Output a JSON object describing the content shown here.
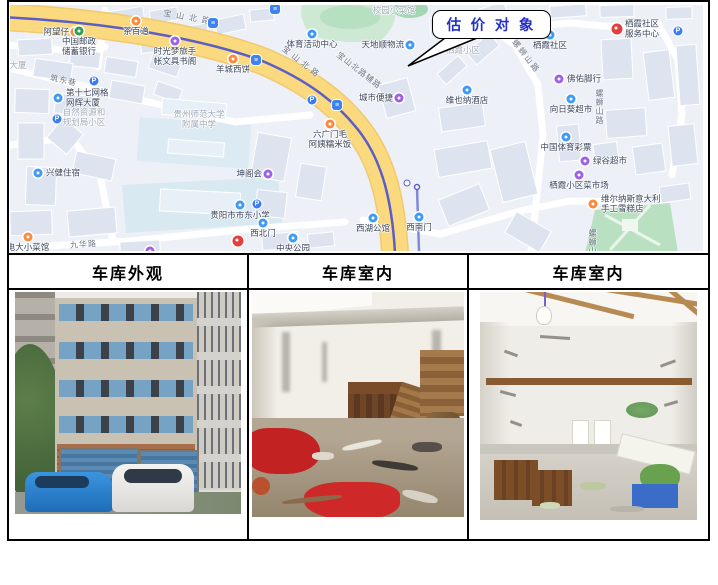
{
  "colors": {
    "poi-orange": "#fb8a3c",
    "poi-blue": "#3d9af5",
    "poi-purple": "#9e61e6",
    "poi-red": "#e2403d",
    "poi-green": "#2f9e4f",
    "transit-blue": "#3d83f0",
    "parking-blue": "#3a7cf2",
    "road-yellow": "#fbd97f",
    "road-yellow-edge": "#f1c96e",
    "metro-line": "#5a5ec6",
    "metro-branch": "#8487d9",
    "map-base": "#edf0f6",
    "building-fill": "#dee4ef",
    "park-green": "#cde9d3",
    "label-dark": "#3c465e",
    "label-gray": "#a3aab9",
    "road-label": "#6e7787",
    "callout-text": "#2531c8",
    "callout-border": "#000000",
    "table-border": "#000000",
    "header-text": "#000000"
  },
  "callout": {
    "text": "估 价 对 象"
  },
  "table": {
    "headers": [
      "车库外观",
      "车库室内",
      "车库室内"
    ]
  },
  "map": {
    "road_labels": [
      {
        "text": "宝山北路",
        "x": 153,
        "y": 7,
        "angle": 10,
        "spacing": 5
      },
      {
        "text": "宝山北路",
        "x": 268,
        "y": 52,
        "angle": 38,
        "spacing": 4
      },
      {
        "text": "宝山北路辅路",
        "x": 322,
        "y": 60,
        "angle": 38,
        "spacing": 1
      },
      {
        "text": "筑东巷",
        "x": 40,
        "y": 70,
        "angle": 12,
        "spacing": 1
      },
      {
        "text": "九华路",
        "x": 60,
        "y": 234,
        "angle": -4,
        "spacing": 1
      },
      {
        "text": "螺蛳山路",
        "x": 496,
        "y": 46,
        "angle": 52,
        "spacing": 2
      },
      {
        "text": "螺蛳山路",
        "x": 584,
        "y": 84,
        "vertical": true
      },
      {
        "text": "螺蛳山",
        "x": 577,
        "y": 224,
        "vertical": true
      }
    ],
    "area_labels": [
      {
        "lines": [
          "自然资源和",
          "规划局小区"
        ],
        "x": 74,
        "y": 103
      },
      {
        "lines": [
          "贵州师范大学",
          "附属中学"
        ],
        "x": 189,
        "y": 105
      },
      {
        "lines": [
          "栖霞小区"
        ],
        "x": 453,
        "y": 41
      },
      {
        "lines": [
          "校园小菜馆"
        ],
        "x": 384,
        "y": 1
      },
      {
        "lines": [
          "大厦"
        ],
        "x": 8,
        "y": 56
      }
    ],
    "pois": [
      {
        "lines": [
          "阿望仔"
        ],
        "x": 65,
        "y": 27,
        "color": "orange",
        "label": "left"
      },
      {
        "lines": [
          "中国邮政",
          "储蓄银行"
        ],
        "x": 69,
        "y": 26,
        "color": "green",
        "label": "below"
      },
      {
        "lines": [
          "茶百道"
        ],
        "x": 126,
        "y": 16,
        "color": "orange",
        "label": "below"
      },
      {
        "lines": [
          "时光梦旅手",
          "帐文具书阁"
        ],
        "x": 165,
        "y": 36,
        "color": "purple",
        "label": "below"
      },
      {
        "lines": [
          "羊城西饼"
        ],
        "x": 223,
        "y": 54,
        "color": "orange",
        "label": "below"
      },
      {
        "lines": [
          "体育活动中心"
        ],
        "x": 302,
        "y": 29,
        "color": "blue",
        "label": "below"
      },
      {
        "lines": [
          "第十七网格",
          "网辉大厦"
        ],
        "x": 48,
        "y": 93,
        "color": "blue",
        "label": "right"
      },
      {
        "lines": [
          "兴健住宿"
        ],
        "x": 28,
        "y": 168,
        "color": "blue",
        "label": "right"
      },
      {
        "lines": [
          "坤阁会"
        ],
        "x": 258,
        "y": 169,
        "color": "purple",
        "label": "left"
      },
      {
        "lines": [
          "贵阳市市东小学"
        ],
        "x": 230,
        "y": 200,
        "color": "blue",
        "label": "below"
      },
      {
        "lines": [
          "电大小菜馆"
        ],
        "x": 18,
        "y": 232,
        "color": "orange",
        "label": "below"
      },
      {
        "lines": [
          "西北门"
        ],
        "x": 253,
        "y": 218,
        "color": "blue",
        "label": "below"
      },
      {
        "lines": [
          "中央公园"
        ],
        "x": 283,
        "y": 233,
        "color": "blue",
        "label": "below"
      },
      {
        "lines": [],
        "x": 228,
        "y": 236,
        "color": "red",
        "label": "none"
      },
      {
        "lines": [],
        "x": 140,
        "y": 246,
        "color": "purple",
        "label": "none"
      },
      {
        "lines": [
          "城市便捷"
        ],
        "x": 389,
        "y": 93,
        "color": "purple",
        "label": "left"
      },
      {
        "lines": [
          "天地顺物流"
        ],
        "x": 400,
        "y": 40,
        "color": "blue",
        "label": "left"
      },
      {
        "lines": [
          "六广门毛",
          "阿姨糯米饭"
        ],
        "x": 320,
        "y": 119,
        "color": "orange",
        "label": "below"
      },
      {
        "lines": [
          "维也纳酒店"
        ],
        "x": 457,
        "y": 85,
        "color": "blue",
        "label": "below"
      },
      {
        "lines": [
          "栖霞社区"
        ],
        "x": 540,
        "y": 30,
        "color": "blue",
        "label": "below"
      },
      {
        "lines": [
          "栖霞社区",
          "服务中心"
        ],
        "x": 607,
        "y": 24,
        "color": "red",
        "label": "right"
      },
      {
        "lines": [
          "佛佑脚行"
        ],
        "x": 549,
        "y": 74,
        "color": "purple",
        "label": "right"
      },
      {
        "lines": [
          "向日葵超市"
        ],
        "x": 561,
        "y": 94,
        "color": "blue",
        "label": "below"
      },
      {
        "lines": [
          "中国体育彩票"
        ],
        "x": 556,
        "y": 132,
        "color": "blue",
        "label": "below"
      },
      {
        "lines": [
          "绿谷超市"
        ],
        "x": 575,
        "y": 156,
        "color": "purple",
        "label": "right"
      },
      {
        "lines": [
          "栖霞小区菜市场"
        ],
        "x": 569,
        "y": 170,
        "color": "purple",
        "label": "below"
      },
      {
        "lines": [
          "维尔纳斯意大利",
          "手工雪糕店"
        ],
        "x": 583,
        "y": 199,
        "color": "orange",
        "label": "right"
      },
      {
        "lines": [
          "西湖公馆"
        ],
        "x": 363,
        "y": 213,
        "color": "blue",
        "label": "below"
      },
      {
        "lines": [
          "西南门"
        ],
        "x": 409,
        "y": 212,
        "color": "blue",
        "label": "below"
      }
    ],
    "badges": [
      {
        "kind": "parking",
        "glyph": "P",
        "x": 84,
        "y": 76
      },
      {
        "kind": "parking",
        "glyph": "P",
        "x": 47,
        "y": 114
      },
      {
        "kind": "parking",
        "glyph": "P",
        "x": 302,
        "y": 95
      },
      {
        "kind": "parking",
        "glyph": "P",
        "x": 247,
        "y": 199
      },
      {
        "kind": "parking",
        "glyph": "P",
        "x": 668,
        "y": 26
      },
      {
        "kind": "transit",
        "glyph": "≡",
        "x": 265,
        "y": 4
      },
      {
        "kind": "transit",
        "glyph": "≡",
        "x": 203,
        "y": 18
      },
      {
        "kind": "transit",
        "glyph": "≡",
        "x": 246,
        "y": 55
      },
      {
        "kind": "transit",
        "glyph": "≡",
        "x": 327,
        "y": 100
      },
      {
        "kind": "dot",
        "glyph": "",
        "x": 397,
        "y": 178
      }
    ]
  }
}
